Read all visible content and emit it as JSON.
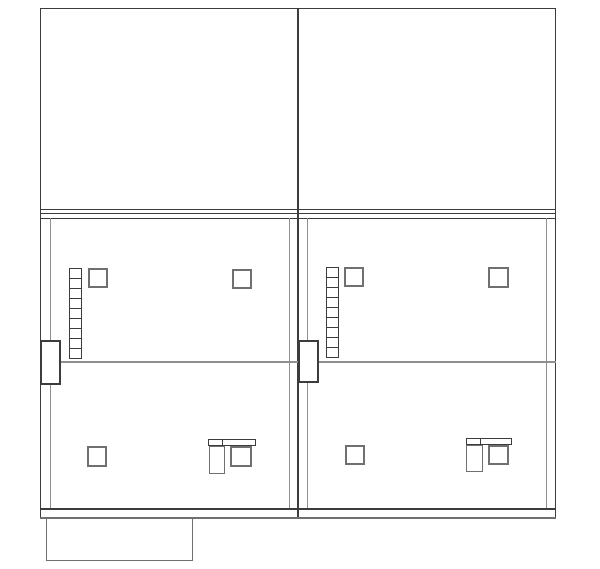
{
  "meta": {
    "title": "Two-unit building section drawing (CAD line work, no text)",
    "canvas_width": 600,
    "canvas_height": 569,
    "background": "#ffffff"
  },
  "colors": {
    "dark": "#3c3c3c",
    "gray": "#8f8f8f",
    "mid": "#707070",
    "white": "#ffffff"
  },
  "shapes": [
    {
      "name": "upper-left-roof-outline",
      "type": "rect",
      "x": 40,
      "y": 8,
      "w": 258,
      "h": 202,
      "stroke": "dark",
      "sw": 1
    },
    {
      "name": "upper-right-roof-outline",
      "type": "rect",
      "x": 298,
      "y": 8,
      "w": 258,
      "h": 202,
      "stroke": "dark",
      "sw": 1
    },
    {
      "name": "floor-slab-top-line",
      "type": "hline",
      "x": 40,
      "y": 213,
      "len": 516,
      "color": "dark",
      "t": 1
    },
    {
      "name": "floor-slab-bottom-line",
      "type": "hline",
      "x": 40,
      "y": 218,
      "len": 516,
      "color": "dark",
      "t": 1
    },
    {
      "name": "left-outer-wall",
      "type": "vline",
      "x": 40,
      "y": 210,
      "len": 308,
      "color": "dark",
      "t": 1
    },
    {
      "name": "party-wall",
      "type": "vline",
      "x": 297,
      "y": 210,
      "len": 308,
      "color": "dark",
      "t": 2
    },
    {
      "name": "right-outer-wall",
      "type": "vline",
      "x": 555,
      "y": 210,
      "len": 308,
      "color": "dark",
      "t": 1
    },
    {
      "name": "left-unit-inner-wall-left",
      "type": "vline",
      "x": 50,
      "y": 218,
      "len": 290,
      "color": "gray",
      "t": 1
    },
    {
      "name": "left-unit-inner-wall-right",
      "type": "vline",
      "x": 289,
      "y": 218,
      "len": 290,
      "color": "gray",
      "t": 1
    },
    {
      "name": "right-unit-inner-wall-left",
      "type": "vline",
      "x": 307,
      "y": 218,
      "len": 290,
      "color": "gray",
      "t": 1
    },
    {
      "name": "right-unit-inner-wall-right",
      "type": "vline",
      "x": 546,
      "y": 218,
      "len": 290,
      "color": "gray",
      "t": 1
    },
    {
      "name": "left-unit-floor-divider",
      "type": "hline",
      "x": 61,
      "y": 361,
      "len": 237,
      "color": "gray",
      "t": 2
    },
    {
      "name": "right-unit-floor-divider",
      "type": "hline",
      "x": 319,
      "y": 361,
      "len": 237,
      "color": "gray",
      "t": 2
    },
    {
      "name": "ground-floor-base-line",
      "type": "hline",
      "x": 40,
      "y": 508,
      "len": 516,
      "color": "dark",
      "t": 1.5
    },
    {
      "name": "foundation-line",
      "type": "hline",
      "x": 40,
      "y": 517,
      "len": 516,
      "color": "mid",
      "t": 1.5
    },
    {
      "name": "left-wall-projection",
      "type": "rect",
      "x": 40,
      "y": 340,
      "w": 21,
      "h": 45,
      "stroke": "dark",
      "sw": 2,
      "fill": "white"
    },
    {
      "name": "party-wall-projection",
      "type": "rect",
      "x": 298,
      "y": 340,
      "w": 21,
      "h": 43,
      "stroke": "dark",
      "sw": 2,
      "fill": "white"
    },
    {
      "name": "left-unit-ladder",
      "type": "ladder",
      "x": 69,
      "y": 268,
      "w": 13,
      "h": 91,
      "cells": 9,
      "color": "dark"
    },
    {
      "name": "right-unit-ladder",
      "type": "ladder",
      "x": 326,
      "y": 267,
      "w": 13,
      "h": 91,
      "cells": 9,
      "color": "dark"
    },
    {
      "name": "left-unit-upper-column-a",
      "type": "rect",
      "x": 88,
      "y": 268,
      "w": 20,
      "h": 20,
      "stroke": "mid",
      "sw": 2
    },
    {
      "name": "left-unit-upper-column-b",
      "type": "rect",
      "x": 232,
      "y": 269,
      "w": 20,
      "h": 20,
      "stroke": "mid",
      "sw": 2
    },
    {
      "name": "right-unit-upper-column-a",
      "type": "rect",
      "x": 344,
      "y": 267,
      "w": 20,
      "h": 20,
      "stroke": "mid",
      "sw": 2
    },
    {
      "name": "right-unit-upper-column-b",
      "type": "rect",
      "x": 488,
      "y": 267,
      "w": 21,
      "h": 21,
      "stroke": "mid",
      "sw": 2
    },
    {
      "name": "left-unit-lower-column",
      "type": "rect",
      "x": 87,
      "y": 446,
      "w": 20,
      "h": 21,
      "stroke": "mid",
      "sw": 2
    },
    {
      "name": "right-unit-lower-column",
      "type": "rect",
      "x": 345,
      "y": 445,
      "w": 20,
      "h": 20,
      "stroke": "mid",
      "sw": 2
    },
    {
      "name": "left-unit-counter-top",
      "type": "rect",
      "x": 208,
      "y": 439,
      "w": 48,
      "h": 7,
      "stroke": "dark",
      "sw": 1.5,
      "fill": "white"
    },
    {
      "name": "left-unit-counter-divider",
      "type": "vline",
      "x": 222,
      "y": 439,
      "len": 7,
      "color": "dark",
      "t": 1
    },
    {
      "name": "left-unit-fixture-tall",
      "type": "rect",
      "x": 209,
      "y": 446,
      "w": 16,
      "h": 28,
      "stroke": "mid",
      "sw": 1.5
    },
    {
      "name": "left-unit-fixture-square",
      "type": "rect",
      "x": 230,
      "y": 446,
      "w": 22,
      "h": 21,
      "stroke": "mid",
      "sw": 2
    },
    {
      "name": "right-unit-counter-top",
      "type": "rect",
      "x": 466,
      "y": 438,
      "w": 46,
      "h": 7,
      "stroke": "dark",
      "sw": 1.5,
      "fill": "white"
    },
    {
      "name": "right-unit-counter-divider",
      "type": "vline",
      "x": 480,
      "y": 438,
      "len": 7,
      "color": "dark",
      "t": 1
    },
    {
      "name": "right-unit-fixture-tall",
      "type": "rect",
      "x": 466,
      "y": 445,
      "w": 17,
      "h": 27,
      "stroke": "mid",
      "sw": 1.5
    },
    {
      "name": "right-unit-fixture-square",
      "type": "rect",
      "x": 488,
      "y": 445,
      "w": 21,
      "h": 20,
      "stroke": "mid",
      "sw": 2
    },
    {
      "name": "porch-slab-outline",
      "type": "rect",
      "x": 46,
      "y": 518,
      "w": 147,
      "h": 43,
      "stroke": "mid",
      "sw": 1.5
    }
  ]
}
